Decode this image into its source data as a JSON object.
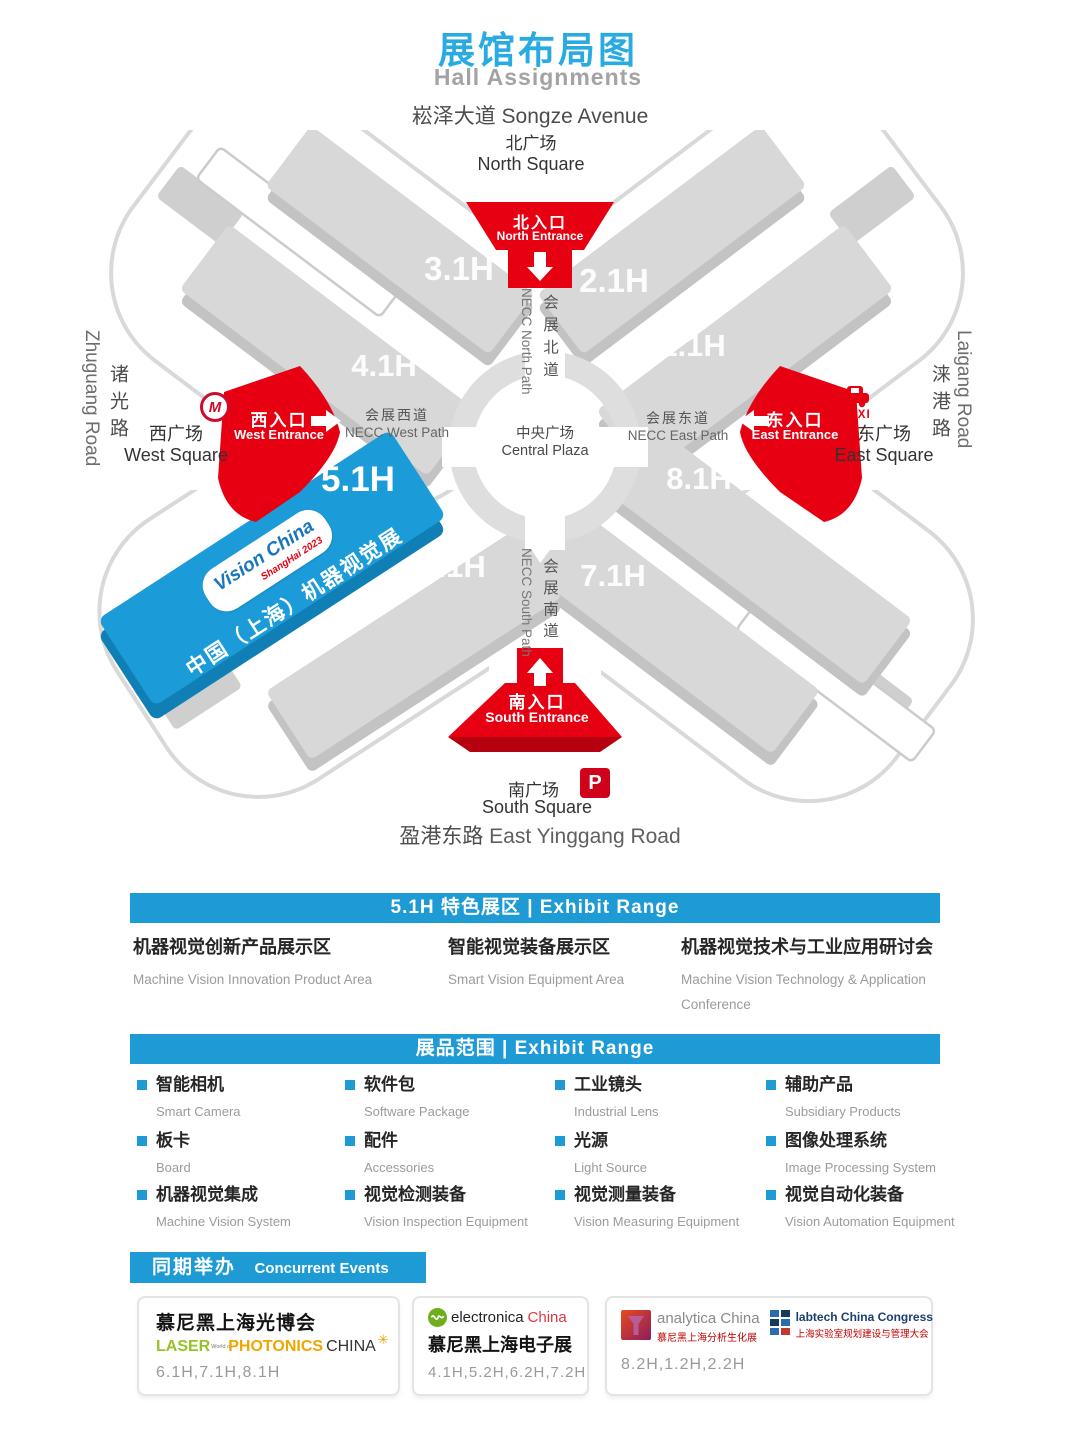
{
  "page": {
    "title_zh": "展馆布局图",
    "title_en": "Hall Assignments"
  },
  "colors": {
    "accent_blue": "#1e9ad5",
    "title_blue": "#29abe2",
    "red": "#e60012",
    "hall_gray": "#d8d8d8",
    "featured_blue": "#1b9cd8"
  },
  "map": {
    "songze": {
      "zh": "崧泽大道",
      "en": "Songze Avenue"
    },
    "north_square": {
      "zh": "北广场",
      "en": "North Square"
    },
    "south_square": {
      "zh": "南广场",
      "en": "South Square"
    },
    "yinggang": {
      "zh": "盈港东路",
      "en": "East Yinggang Road"
    },
    "west_road": {
      "zh": "诸光路",
      "en": "Zhuguang Road"
    },
    "east_road": {
      "zh": "涞港路",
      "en": "Laigang Road"
    },
    "west_square": {
      "zh": "西广场",
      "en": "West Square"
    },
    "east_square": {
      "zh": "东广场",
      "en": "East Square"
    },
    "central_plaza": {
      "zh": "中央广场",
      "en": "Central Plaza"
    },
    "entrances": {
      "north": {
        "zh": "北入口",
        "en": "North Entrance"
      },
      "south": {
        "zh": "南入口",
        "en": "South Entrance"
      },
      "west": {
        "zh": "西入口",
        "en": "West Entrance"
      },
      "east": {
        "zh": "东入口",
        "en": "East Entrance"
      }
    },
    "paths": {
      "north": {
        "zh": "会展北道",
        "en": "NECC North Path"
      },
      "south": {
        "zh": "会展南道",
        "en": "NECC South Path"
      },
      "west": {
        "zh": "会展西道",
        "en": "NECC West Path"
      },
      "east": {
        "zh": "会展东道",
        "en": "NECC East Path"
      }
    },
    "halls": {
      "h11": "1.1H",
      "h21": "2.1H",
      "h31": "3.1H",
      "h41": "4.1H",
      "h51": "5.1H",
      "h61": "6.1H",
      "h71": "7.1H",
      "h81": "8.1H"
    },
    "featured": {
      "logo_line1": "Vision China",
      "logo_line2": "ShangHai 2023",
      "name_zh": "中国（上海）机器视觉展"
    },
    "metro": "M",
    "taxi": "TAXI",
    "parking": "P"
  },
  "featured_section": {
    "header": "5.1H 特色展区 | Exhibit Range",
    "items": [
      {
        "zh": "机器视觉创新产品展示区",
        "en": "Machine Vision Innovation Product Area"
      },
      {
        "zh": "智能视觉装备展示区",
        "en": "Smart Vision Equipment Area"
      },
      {
        "zh": "机器视觉技术与工业应用研讨会",
        "en": "Machine Vision Technology & Application Conference"
      }
    ]
  },
  "exhibit_section": {
    "header": "展品范围 | Exhibit Range",
    "items": [
      {
        "zh": "智能相机",
        "en": "Smart Camera"
      },
      {
        "zh": "软件包",
        "en": "Software Package"
      },
      {
        "zh": "工业镜头",
        "en": "Industrial Lens"
      },
      {
        "zh": "辅助产品",
        "en": "Subsidiary Products"
      },
      {
        "zh": "板卡",
        "en": "Board"
      },
      {
        "zh": "配件",
        "en": "Accessories"
      },
      {
        "zh": "光源",
        "en": "Light Source"
      },
      {
        "zh": "图像处理系统",
        "en": "Image Processing System"
      },
      {
        "zh": "机器视觉集成",
        "en": "Machine Vision System"
      },
      {
        "zh": "视觉检测装备",
        "en": "Vision Inspection Equipment"
      },
      {
        "zh": "视觉测量装备",
        "en": "Vision Measuring Equipment"
      },
      {
        "zh": "视觉自动化装备",
        "en": "Vision Automation Equipment"
      }
    ]
  },
  "concurrent_section": {
    "header_zh": "同期举办",
    "header_en": "Concurrent Events",
    "events": [
      {
        "title": "慕尼黑上海光博会",
        "logo": {
          "laser": "LASER",
          "world": "World of",
          "photonics": "PHOTONICS",
          "china": "CHINA",
          "star": "✳"
        },
        "halls": "6.1H,7.1H,8.1H"
      },
      {
        "title": "慕尼黑上海电子展",
        "logo": {
          "name": "electronica",
          "suffix": "China"
        },
        "halls": "4.1H,5.2H,6.2H,7.2H"
      },
      {
        "logo1": {
          "name": "analytica China",
          "sub": "慕尼黑上海分析生化展"
        },
        "logo2": {
          "name": "labtech China Congress",
          "sub": "上海实验室规划建设与管理大会"
        },
        "halls": "8.2H,1.2H,2.2H"
      }
    ]
  }
}
